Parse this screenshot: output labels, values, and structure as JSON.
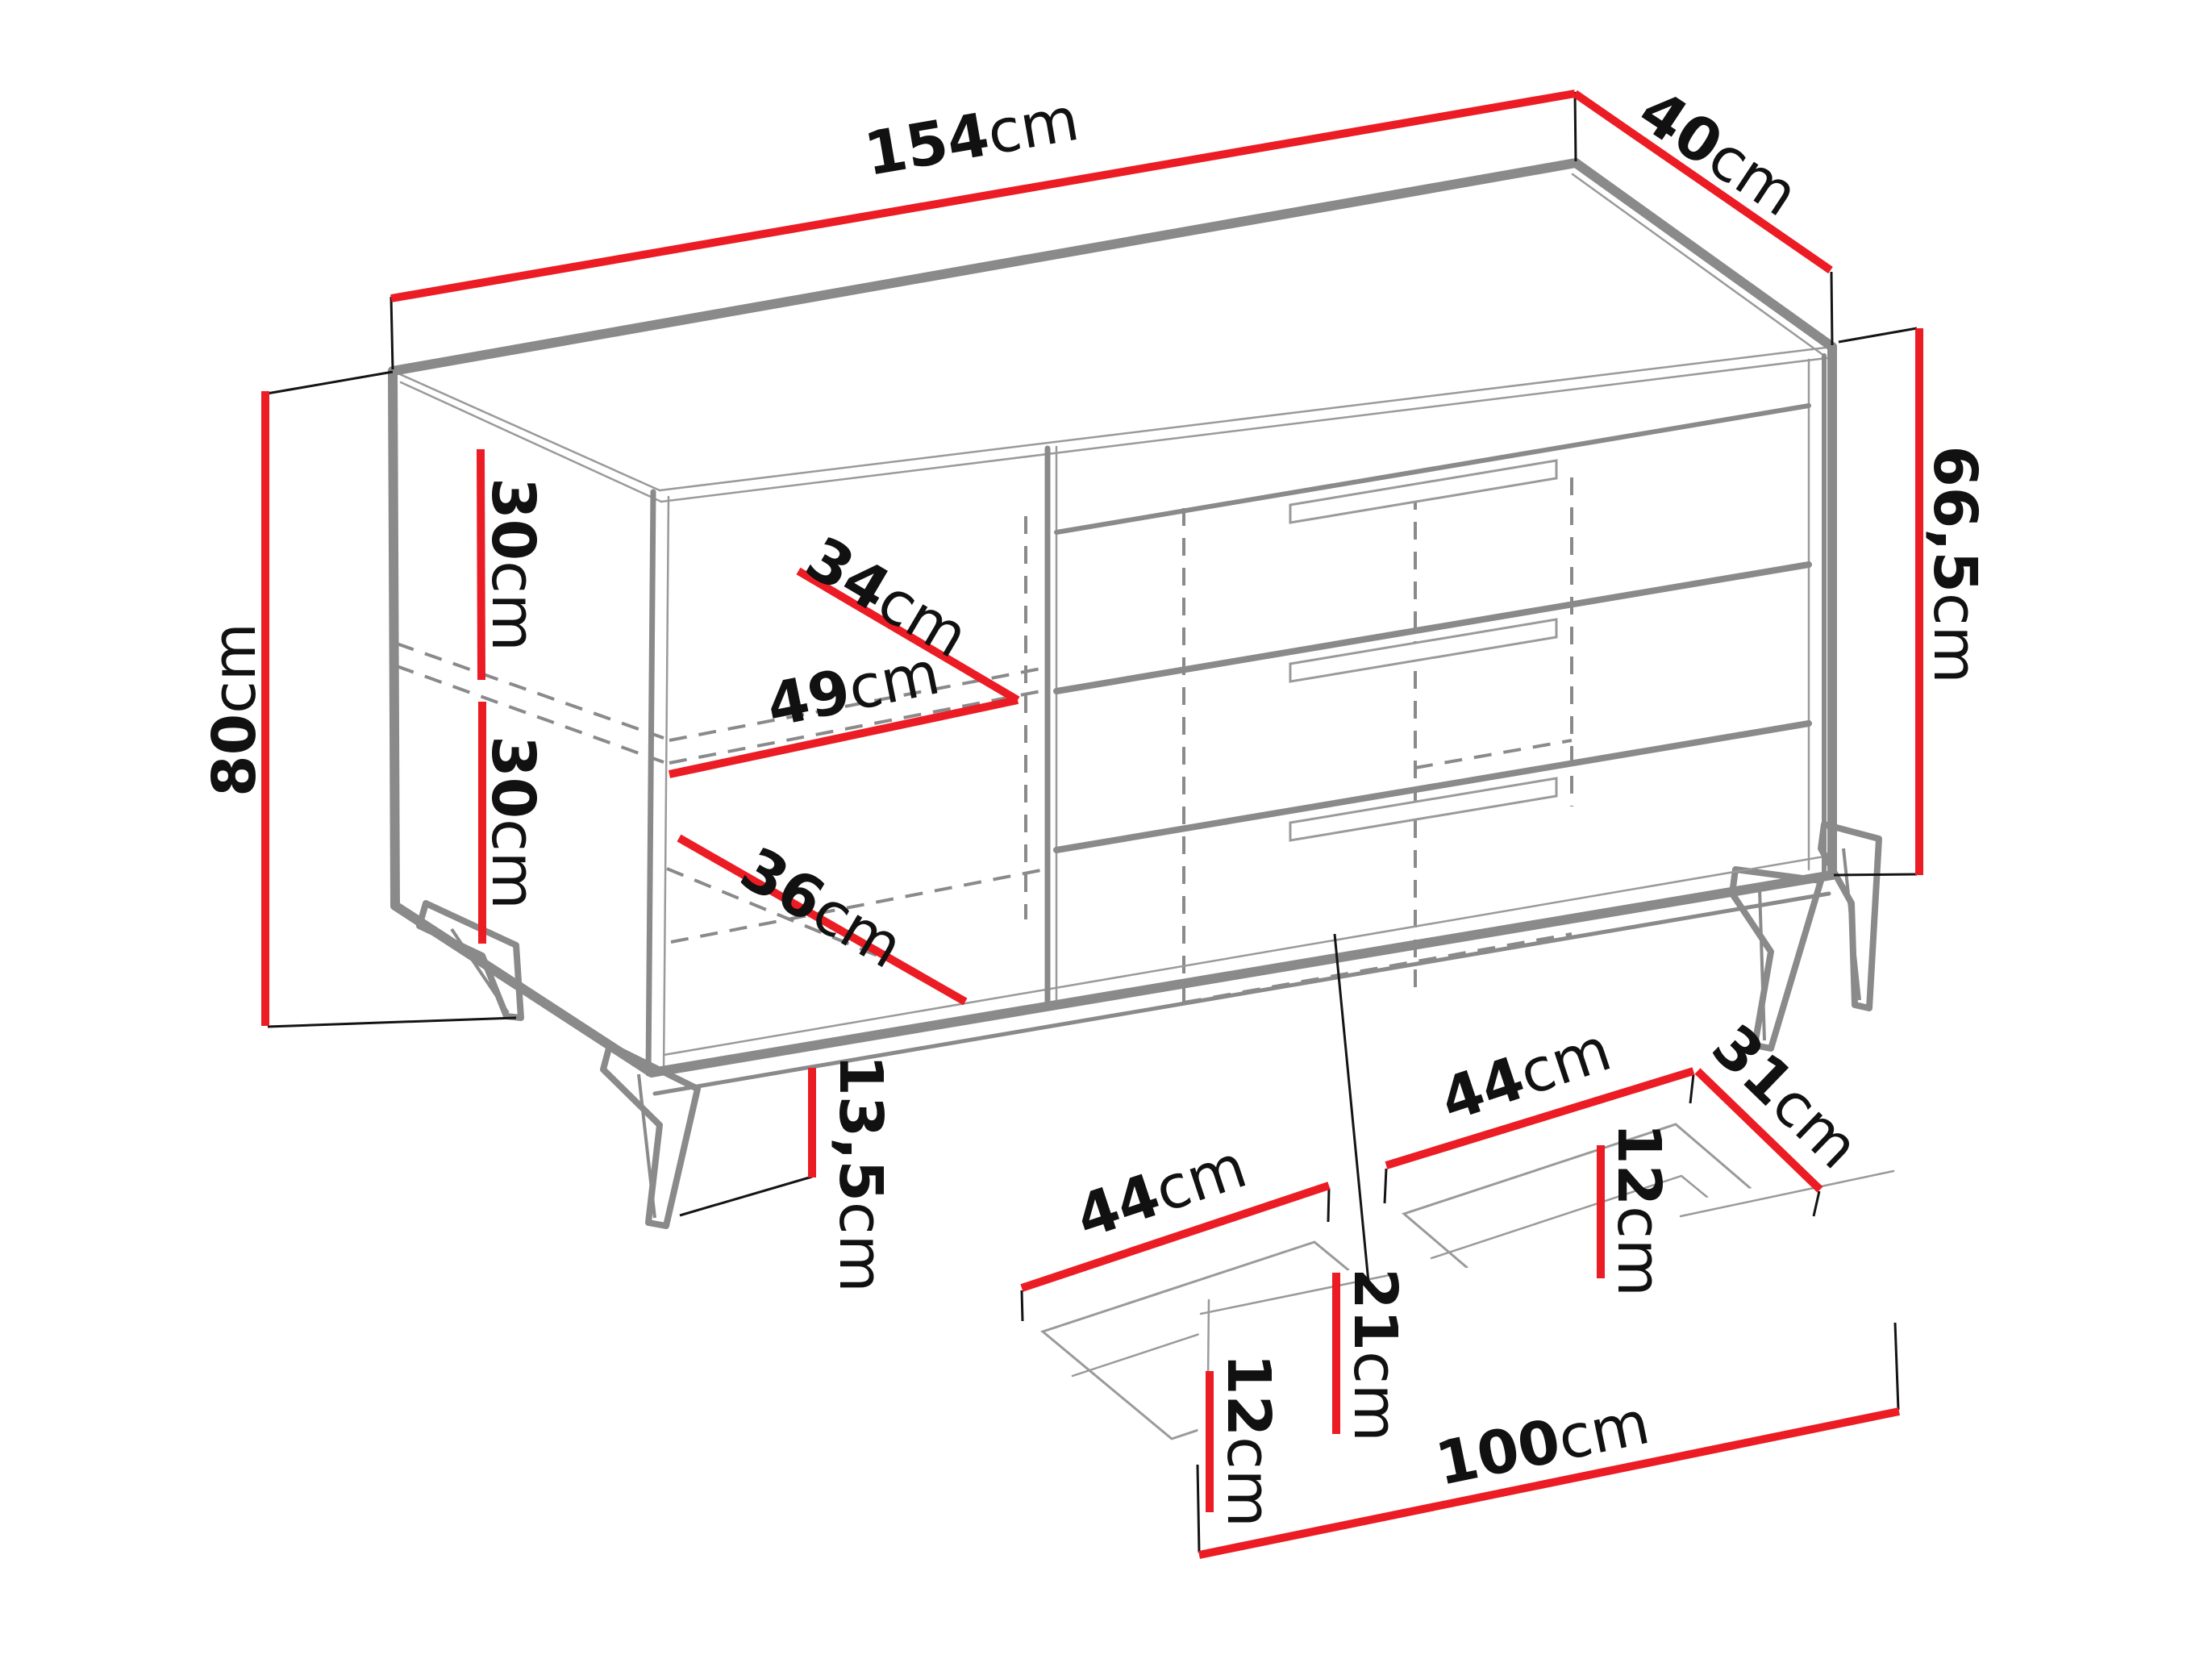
{
  "diagram": {
    "type": "furniture-dimension-diagram",
    "subject": "sideboard chest with open shelves, three drawers and a pulled-out drawer detail",
    "background": "#ffffff",
    "colors": {
      "dimension_line": "#ec1c24",
      "outline": "#8a8a8a",
      "extension_line": "#141414",
      "text": "#111111"
    }
  },
  "cabinet": {
    "width": {
      "num": "154",
      "unit": "cm"
    },
    "depth": {
      "num": "40",
      "unit": "cm"
    },
    "total_height": {
      "num": "80",
      "unit": "cm"
    },
    "body_height": {
      "num": "66,5",
      "unit": "cm"
    },
    "shelf_space_top": {
      "num": "30",
      "unit": "cm"
    },
    "shelf_space_bottom": {
      "num": "30",
      "unit": "cm"
    },
    "inner_depth": {
      "num": "34",
      "unit": "cm"
    },
    "inner_width_shelf": {
      "num": "49",
      "unit": "cm"
    },
    "inner_width_bottom": {
      "num": "36",
      "unit": "cm"
    },
    "leg_height": {
      "num": "13,5",
      "unit": "cm"
    }
  },
  "drawer": {
    "left_inner_width": {
      "num": "44",
      "unit": "cm"
    },
    "right_inner_width": {
      "num": "44",
      "unit": "cm"
    },
    "inner_depth": {
      "num": "31",
      "unit": "cm"
    },
    "left_inner_height": {
      "num": "12",
      "unit": "cm"
    },
    "right_inner_height": {
      "num": "12",
      "unit": "cm"
    },
    "front_height": {
      "num": "21",
      "unit": "cm"
    },
    "front_width": {
      "num": "100",
      "unit": "cm"
    }
  }
}
